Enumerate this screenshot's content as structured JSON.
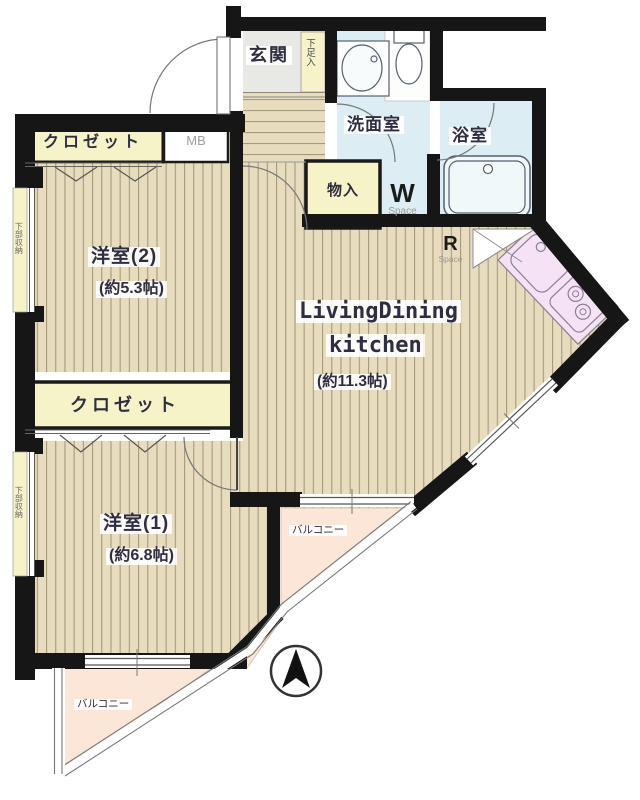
{
  "rooms": {
    "entrance": {
      "label": "玄関"
    },
    "shoe_storage": {
      "label": "下足入"
    },
    "washroom": {
      "label": "洗面室"
    },
    "bathroom": {
      "label": "浴室"
    },
    "storage": {
      "label": "物入"
    },
    "washer_space": {
      "letter": "W",
      "sub": "Space"
    },
    "fridge_space": {
      "letter": "R",
      "sub": "Space"
    },
    "ldk": {
      "line1": "LivingDining",
      "line2": "kitchen",
      "size": "(約11.3帖)"
    },
    "bedroom2": {
      "label": "洋室(2)",
      "size": "(約5.3帖)"
    },
    "bedroom1": {
      "label": "洋室(1)",
      "size": "(約6.8帖)"
    },
    "closet_top": {
      "label": "クロゼット"
    },
    "closet_mid": {
      "label": "クロゼット"
    },
    "meter_box": {
      "label": "MB"
    },
    "balcony_ldk": {
      "label": "バルコニー"
    },
    "balcony_bedroom1": {
      "label": "バルコニー"
    },
    "under_storage_bedroom2": {
      "label": "下部収納"
    },
    "under_storage_bedroom1": {
      "label": "下部収納"
    }
  },
  "colors": {
    "wall": "#161616",
    "floor": "#e8dcbe",
    "floor_line": "#a79a7c",
    "closet_yellow": "#f7f3c8",
    "water_blue": "#dceef3",
    "kitchen_pink": "#f5e2f4",
    "balcony_peach": "#fce6d8",
    "entrance_tile": "#e8e8e4"
  }
}
